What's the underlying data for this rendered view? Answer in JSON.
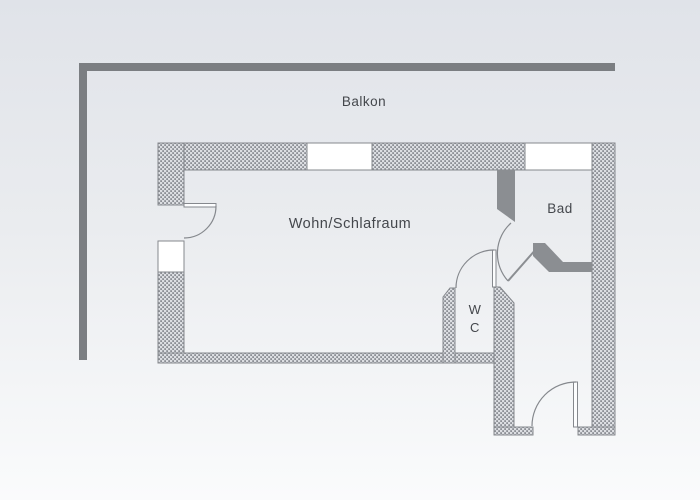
{
  "figure": {
    "type": "apartment-floor-plan",
    "language": "German"
  },
  "rooms": {
    "balcony": {
      "label": "Balkon"
    },
    "living": {
      "label": "Wohn/Schlafraum"
    },
    "bath": {
      "label": "Bad"
    },
    "wc": {
      "line1": "W",
      "line2": "C"
    }
  },
  "features": {
    "windows": [
      "top-wall-window-left",
      "top-wall-window-right",
      "left-wall-window"
    ],
    "doors": [
      "balcony-door",
      "bath-door",
      "wc-door",
      "entrance-door"
    ],
    "railing": "balcony-railing"
  },
  "colors": {
    "background_top": "#e0e3e9",
    "background_mid": "#eaecef",
    "background_bottom": "#fafbfc",
    "wall_outline": "#85888d",
    "solid_wall": "#8b8e92",
    "railing": "#7b7e82",
    "window_fill": "#ffffff",
    "text": "#44474c"
  }
}
